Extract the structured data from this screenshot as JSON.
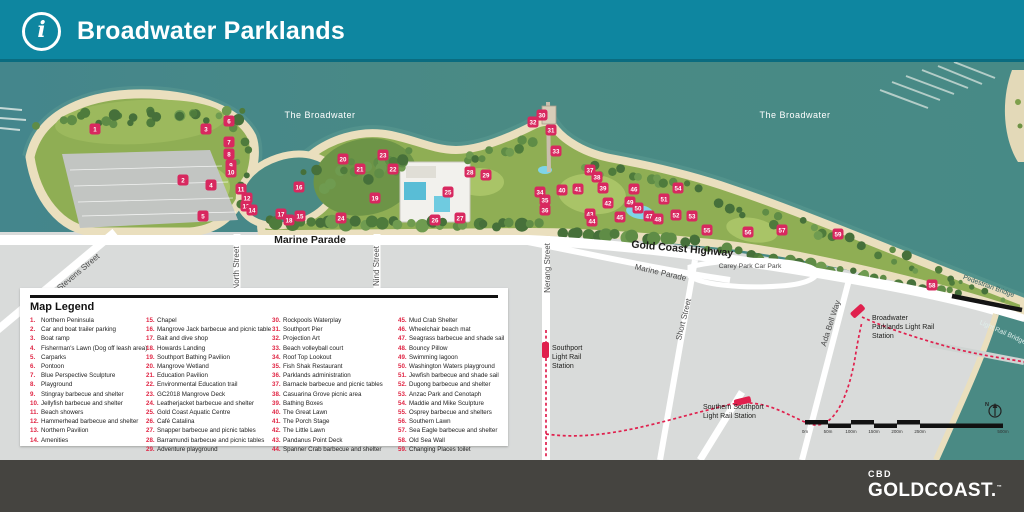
{
  "header": {
    "title": "Broadwater Parklands"
  },
  "footer": {
    "brand_top": "CBD",
    "brand_main": "GOLDCOAST.",
    "brand_tm": "™"
  },
  "colors": {
    "header_teal": "#0E86A0",
    "water": "#4A8A84",
    "sand": "#EADFBE",
    "park_green": "#8FAE54",
    "marker_red": "#D8285F",
    "legend_num_red": "#E02443",
    "rail_red": "#E0204D",
    "road_white": "#FFFFFF",
    "footer_charcoal": "#454440"
  },
  "map": {
    "water_labels": [
      {
        "t": "The Broadwater",
        "x": 320,
        "y": 56
      },
      {
        "t": "The Broadwater",
        "x": 795,
        "y": 56
      }
    ],
    "street_labels": [
      {
        "t": "Marine Parade",
        "x": 310,
        "y": 181,
        "r": 0,
        "s": 10.5,
        "w": "bold",
        "c": "#1D1D1B"
      },
      {
        "t": "Gold Coast Highway",
        "x": 682,
        "y": 190,
        "r": 5,
        "s": 10.5,
        "w": "bold",
        "c": "#1D1D1B"
      },
      {
        "t": "Stevens Street",
        "x": 80,
        "y": 212,
        "r": -40,
        "s": 8,
        "w": "normal",
        "c": "#4A4A4A"
      },
      {
        "t": "North Street",
        "x": 239,
        "y": 206,
        "r": -90,
        "s": 8,
        "w": "normal",
        "c": "#4A4A4A"
      },
      {
        "t": "Nind Street",
        "x": 379,
        "y": 204,
        "r": -90,
        "s": 8,
        "w": "normal",
        "c": "#4A4A4A"
      },
      {
        "t": "Nerang Street",
        "x": 550,
        "y": 206,
        "r": -90,
        "s": 8,
        "w": "normal",
        "c": "#4A4A4A"
      },
      {
        "t": "Marine Parade",
        "x": 660,
        "y": 213,
        "r": 13,
        "s": 8,
        "w": "normal",
        "c": "#4A4A4A"
      },
      {
        "t": "Carey Park Car Park",
        "x": 750,
        "y": 206,
        "r": 0,
        "s": 6.8,
        "w": "normal",
        "c": "#4A4A4A"
      },
      {
        "t": "Short Street",
        "x": 686,
        "y": 258,
        "r": -76,
        "s": 8,
        "w": "normal",
        "c": "#4A4A4A"
      },
      {
        "t": "Ada Bell Way",
        "x": 833,
        "y": 262,
        "r": -72,
        "s": 8,
        "w": "normal",
        "c": "#4A4A4A"
      },
      {
        "t": "Pedestrian Bridge",
        "x": 988,
        "y": 226,
        "r": 20,
        "s": 6.8,
        "w": "normal",
        "c": "#2E5A5E"
      },
      {
        "t": "Light Rail Bridge",
        "x": 1002,
        "y": 272,
        "r": 24,
        "s": 6.8,
        "w": "normal",
        "c": "#DFEEEA"
      }
    ],
    "station_labels": [
      {
        "lines": [
          "Broadwater",
          "Parklands Light Rail",
          "Station"
        ],
        "x": 872,
        "y": 258,
        "s": 7,
        "c": "#1D1D1B"
      },
      {
        "lines": [
          "Southport",
          "Light Rail",
          "Station"
        ],
        "x": 552,
        "y": 288,
        "s": 7,
        "c": "#1D1D1B"
      },
      {
        "lines": [
          "Southern Southport",
          "Light Rail Station"
        ],
        "x": 703,
        "y": 347,
        "s": 7,
        "c": "#1D1D1B"
      }
    ],
    "scale_bar": {
      "labels": [
        "0m",
        "50m",
        "100m",
        "150m",
        "200m",
        "250m",
        "500m"
      ]
    },
    "north_label": "N",
    "markers": [
      {
        "n": 1,
        "x": 95,
        "y": 67
      },
      {
        "n": 2,
        "x": 183,
        "y": 118
      },
      {
        "n": 3,
        "x": 206,
        "y": 67
      },
      {
        "n": 4,
        "x": 211,
        "y": 123
      },
      {
        "n": 5,
        "x": 203,
        "y": 154
      },
      {
        "n": 6,
        "x": 229,
        "y": 59
      },
      {
        "n": 7,
        "x": 229,
        "y": 80
      },
      {
        "n": 8,
        "x": 229,
        "y": 92
      },
      {
        "n": 9,
        "x": 231,
        "y": 103
      },
      {
        "n": 10,
        "x": 231,
        "y": 110
      },
      {
        "n": 11,
        "x": 241,
        "y": 127
      },
      {
        "n": 12,
        "x": 247,
        "y": 136
      },
      {
        "n": 13,
        "x": 246,
        "y": 144
      },
      {
        "n": 14,
        "x": 252,
        "y": 148
      },
      {
        "n": 15,
        "x": 300,
        "y": 154
      },
      {
        "n": 16,
        "x": 299,
        "y": 125
      },
      {
        "n": 17,
        "x": 281,
        "y": 152
      },
      {
        "n": 18,
        "x": 289,
        "y": 158
      },
      {
        "n": 19,
        "x": 375,
        "y": 136
      },
      {
        "n": 20,
        "x": 343,
        "y": 97
      },
      {
        "n": 21,
        "x": 360,
        "y": 107
      },
      {
        "n": 22,
        "x": 393,
        "y": 107
      },
      {
        "n": 23,
        "x": 383,
        "y": 93
      },
      {
        "n": 24,
        "x": 341,
        "y": 156
      },
      {
        "n": 25,
        "x": 448,
        "y": 130
      },
      {
        "n": 26,
        "x": 435,
        "y": 158
      },
      {
        "n": 27,
        "x": 460,
        "y": 156
      },
      {
        "n": 28,
        "x": 470,
        "y": 110
      },
      {
        "n": 29,
        "x": 486,
        "y": 113
      },
      {
        "n": 30,
        "x": 542,
        "y": 53
      },
      {
        "n": 31,
        "x": 551,
        "y": 68
      },
      {
        "n": 32,
        "x": 533,
        "y": 60
      },
      {
        "n": 33,
        "x": 556,
        "y": 89
      },
      {
        "n": 34,
        "x": 540,
        "y": 130
      },
      {
        "n": 35,
        "x": 545,
        "y": 138
      },
      {
        "n": 36,
        "x": 545,
        "y": 148
      },
      {
        "n": 37,
        "x": 590,
        "y": 108
      },
      {
        "n": 38,
        "x": 597,
        "y": 115
      },
      {
        "n": 39,
        "x": 603,
        "y": 126
      },
      {
        "n": 40,
        "x": 562,
        "y": 128
      },
      {
        "n": 41,
        "x": 578,
        "y": 127
      },
      {
        "n": 42,
        "x": 608,
        "y": 141
      },
      {
        "n": 43,
        "x": 590,
        "y": 152
      },
      {
        "n": 44,
        "x": 592,
        "y": 159
      },
      {
        "n": 45,
        "x": 620,
        "y": 155
      },
      {
        "n": 46,
        "x": 634,
        "y": 127
      },
      {
        "n": 47,
        "x": 649,
        "y": 154
      },
      {
        "n": 48,
        "x": 658,
        "y": 157
      },
      {
        "n": 49,
        "x": 630,
        "y": 140
      },
      {
        "n": 50,
        "x": 638,
        "y": 146
      },
      {
        "n": 51,
        "x": 664,
        "y": 137
      },
      {
        "n": 52,
        "x": 676,
        "y": 153
      },
      {
        "n": 53,
        "x": 692,
        "y": 154
      },
      {
        "n": 54,
        "x": 678,
        "y": 126
      },
      {
        "n": 55,
        "x": 707,
        "y": 168
      },
      {
        "n": 56,
        "x": 748,
        "y": 170
      },
      {
        "n": 57,
        "x": 782,
        "y": 168
      },
      {
        "n": 58,
        "x": 932,
        "y": 223
      },
      {
        "n": 59,
        "x": 838,
        "y": 172
      }
    ]
  },
  "legend": {
    "title": "Map Legend",
    "columns": [
      [
        {
          "n": "1.",
          "label": "Northern Peninsula"
        },
        {
          "n": "2.",
          "label": "Car and boat trailer parking"
        },
        {
          "n": "3.",
          "label": "Boat ramp"
        },
        {
          "n": "4.",
          "label": "Fisherman's Lawn (Dog off leash area)"
        },
        {
          "n": "5.",
          "label": "Carparks"
        },
        {
          "n": "6.",
          "label": "Pontoon"
        },
        {
          "n": "7.",
          "label": "Blue Perspective Sculpture"
        },
        {
          "n": "8.",
          "label": "Playground"
        },
        {
          "n": "9.",
          "label": "Stingray barbecue and shelter"
        },
        {
          "n": "10.",
          "label": "Jellyfish barbecue and shelter"
        },
        {
          "n": "11.",
          "label": "Beach showers"
        },
        {
          "n": "12.",
          "label": "Hammerhead barbecue and shelter"
        },
        {
          "n": "13.",
          "label": "Northern Pavilion"
        },
        {
          "n": "14.",
          "label": "Amenities"
        }
      ],
      [
        {
          "n": "15.",
          "label": "Chapel"
        },
        {
          "n": "16.",
          "label": "Mangrove Jack barbecue and picnic table"
        },
        {
          "n": "17.",
          "label": "Bait and dive shop"
        },
        {
          "n": "18.",
          "label": "Howards Landing"
        },
        {
          "n": "19.",
          "label": "Southport Bathing Pavilion"
        },
        {
          "n": "20.",
          "label": "Mangrove Wetland"
        },
        {
          "n": "21.",
          "label": "Education Pavilion"
        },
        {
          "n": "22.",
          "label": "Environmental Education trail"
        },
        {
          "n": "23.",
          "label": "GC2018 Mangrove Deck"
        },
        {
          "n": "24.",
          "label": "Leatherjacket barbecue and shelter"
        },
        {
          "n": "25.",
          "label": "Gold Coast Aquatic Centre"
        },
        {
          "n": "26.",
          "label": "Café Catalina"
        },
        {
          "n": "27.",
          "label": "Snapper barbecue and picnic tables"
        },
        {
          "n": "28.",
          "label": "Barramundi barbecue and picnic tables"
        },
        {
          "n": "29.",
          "label": "Adventure playground"
        }
      ],
      [
        {
          "n": "30.",
          "label": "Rockpools Waterplay"
        },
        {
          "n": "31.",
          "label": "Southport Pier"
        },
        {
          "n": "32.",
          "label": "Projection Art"
        },
        {
          "n": "33.",
          "label": "Beach volleyball court"
        },
        {
          "n": "34.",
          "label": "Roof Top Lookout"
        },
        {
          "n": "35.",
          "label": "Fish Shak Restaurant"
        },
        {
          "n": "36.",
          "label": "Parklands administration"
        },
        {
          "n": "37.",
          "label": "Barnacle barbecue and picnic tables"
        },
        {
          "n": "38.",
          "label": "Casuarina Grove picnic area"
        },
        {
          "n": "39.",
          "label": "Bathing Boxes"
        },
        {
          "n": "40.",
          "label": "The Great Lawn"
        },
        {
          "n": "41.",
          "label": "The Porch Stage"
        },
        {
          "n": "42.",
          "label": "The Little Lawn"
        },
        {
          "n": "43.",
          "label": "Pandanus Point Deck"
        },
        {
          "n": "44.",
          "label": "Spanner Crab barbecue and shelter"
        }
      ],
      [
        {
          "n": "45.",
          "label": "Mud Crab Shelter"
        },
        {
          "n": "46.",
          "label": "Wheelchair beach mat"
        },
        {
          "n": "47.",
          "label": "Seagrass barbecue and shade sail"
        },
        {
          "n": "48.",
          "label": "Bouncy Pillow"
        },
        {
          "n": "49.",
          "label": "Swimming lagoon"
        },
        {
          "n": "50.",
          "label": "Washington Waters playground"
        },
        {
          "n": "51.",
          "label": "Jewfish barbecue and shade sail"
        },
        {
          "n": "52.",
          "label": "Dugong barbecue and shelter"
        },
        {
          "n": "53.",
          "label": "Anzac Park and Cenotaph"
        },
        {
          "n": "54.",
          "label": "Maddie and Mike Sculpture"
        },
        {
          "n": "55.",
          "label": "Osprey barbecue and shelters"
        },
        {
          "n": "56.",
          "label": "Southern Lawn"
        },
        {
          "n": "57.",
          "label": "Sea Eagle barbecue and shelter"
        },
        {
          "n": "58.",
          "label": "Old Sea Wall"
        },
        {
          "n": "59.",
          "label": "Changing Places toilet"
        }
      ]
    ]
  }
}
